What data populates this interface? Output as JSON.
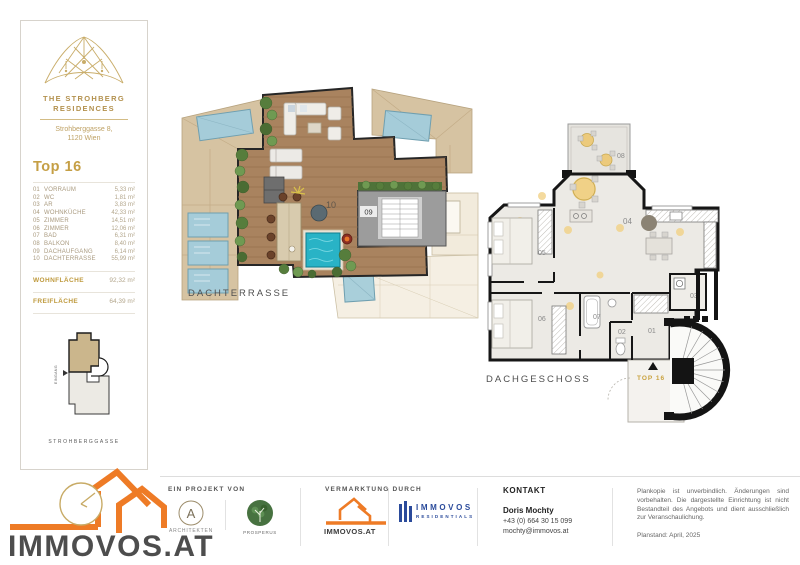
{
  "sidebar": {
    "brand1": "THE STROHBERG",
    "brand2": "RESIDENCES",
    "address1": "Strohberggasse 8,",
    "address2": "1120 Wien",
    "unit": "Top 16",
    "rooms": [
      {
        "no": "01",
        "name": "VORRAUM",
        "area": "5,33 m²"
      },
      {
        "no": "02",
        "name": "WC",
        "area": "1,81 m²"
      },
      {
        "no": "03",
        "name": "AR",
        "area": "3,83 m²"
      },
      {
        "no": "04",
        "name": "WOHNKÜCHE",
        "area": "42,33 m²"
      },
      {
        "no": "05",
        "name": "ZIMMER",
        "area": "14,51 m²"
      },
      {
        "no": "06",
        "name": "ZIMMER",
        "area": "12,06 m²"
      },
      {
        "no": "07",
        "name": "BAD",
        "area": "6,31 m²"
      },
      {
        "no": "08",
        "name": "BALKON",
        "area": "8,40 m²"
      },
      {
        "no": "09",
        "name": "DACHAUFGANG",
        "area": "6,14 m²"
      },
      {
        "no": "10",
        "name": "DACHTERRASSE",
        "area": "55,99 m²"
      }
    ],
    "totals": [
      {
        "label": "WOHNFLÄCHE",
        "value": "92,32 m²"
      },
      {
        "label": "FREIFLÄCHE",
        "value": "64,39 m²"
      }
    ],
    "siteplan": {
      "street": "STROHBERGGASSE",
      "entrance": "EINGANG"
    }
  },
  "plans": {
    "terrace": {
      "caption": "DACHTERRASSE",
      "num_terrace": "10",
      "num_stairs": "09"
    },
    "floor": {
      "caption": "DACHGESCHOSS",
      "num_balkon": "08",
      "num_wohnkueche": "04",
      "num_zimmer_05": "05",
      "num_zimmer_06": "06",
      "num_bad": "07",
      "num_ar": "03",
      "num_wc": "02",
      "num_vorraum": "01",
      "entrance": "TOP 16"
    }
  },
  "footer": {
    "project_label": "EIN PROJEKT VON",
    "architect": "ARCHITEKTEN",
    "partner": "PROSPERUS",
    "marketing_label": "VERMARKTUNG DURCH",
    "logo_small": "IMMOVOS.AT",
    "res1": "IMMOVOS",
    "res2": "RESIDENTIALS",
    "kontakt_label": "KONTAKT",
    "contact_name": "Doris Mochty",
    "contact_phone": "+43 (0) 664 30 15 099",
    "contact_email": "mochty@immovos.at",
    "disclaimer": "Plankopie ist unverbindlich. Änderungen sind vorbehalten. Die dargestellte Einrichtung ist nicht Bestandteil des Angebots und dient ausschließlich zur Veranschaulichung.",
    "plandate": "Planstand: April, 2025",
    "wordmark": "IMMOVOS.AT"
  },
  "colors": {
    "gold": "#c1a25c",
    "gold_dark": "#bf9a3e",
    "orange": "#ee7b26",
    "navy": "#2b4b9b",
    "roof_tan": "#d6c3a2",
    "terrace_wood": "#a9835f",
    "pool_blue": "#29b3c6",
    "skylight_blue": "#a5ccd9",
    "plant_green": "#567d3c"
  }
}
